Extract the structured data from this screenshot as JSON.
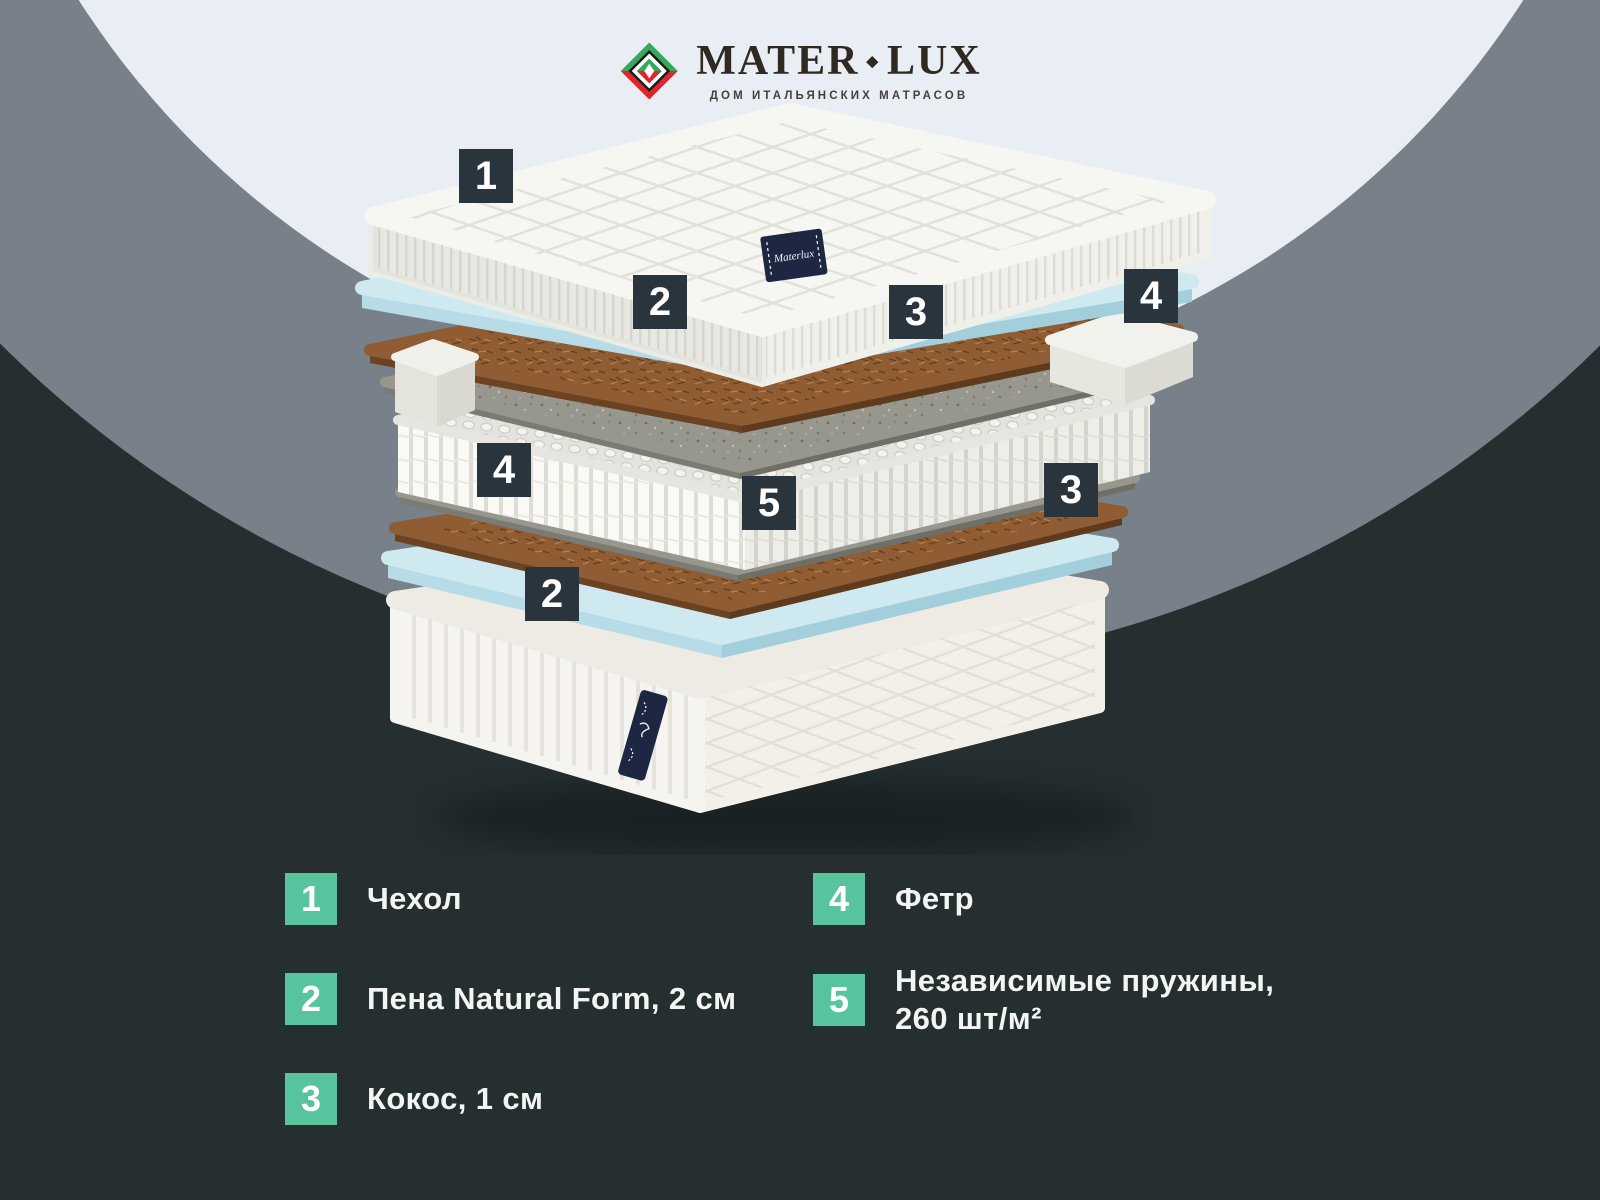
{
  "logo": {
    "name_left": "MATER",
    "separator": "◆",
    "name_right": "LUX",
    "tagline": "ДОМ ИТАЛЬЯНСКИХ МАТРАСОВ"
  },
  "mattress": {
    "tag_text": "Materlux",
    "layers_top_to_bottom": [
      "Чехол",
      "Пена Natural Form",
      "Кокос",
      "Фетр",
      "Независимые пружины",
      "Фетр",
      "Кокос",
      "Пена Natural Form",
      "Основание"
    ]
  },
  "callouts": [
    {
      "number": "1"
    },
    {
      "number": "2"
    },
    {
      "number": "3"
    },
    {
      "number": "4"
    },
    {
      "number": "4"
    },
    {
      "number": "5"
    },
    {
      "number": "3"
    },
    {
      "number": "2"
    }
  ],
  "legend": {
    "items": [
      {
        "num": "1",
        "label": "Чехол"
      },
      {
        "num": "2",
        "label": "Пена Natural Form, 2 см"
      },
      {
        "num": "3",
        "label": "Кокос, 1 см"
      },
      {
        "num": "4",
        "label": "Фетр"
      },
      {
        "num": "5",
        "label": "Независимые пружины,\n260 шт/м²"
      }
    ]
  },
  "colors": {
    "background_dark": "#252F30",
    "circle_gray": "#78818A",
    "circle_light": "#E9EDF4",
    "accent_teal": "#57C49D",
    "callout_dark": "#2A343D",
    "logo_green": "#36A85B",
    "logo_red": "#E3242B",
    "foam_blue": "#CFE9F1",
    "coir_brown": "#8F5C33",
    "felt_gray": "#97978E",
    "tag_navy": "#1D2742"
  }
}
